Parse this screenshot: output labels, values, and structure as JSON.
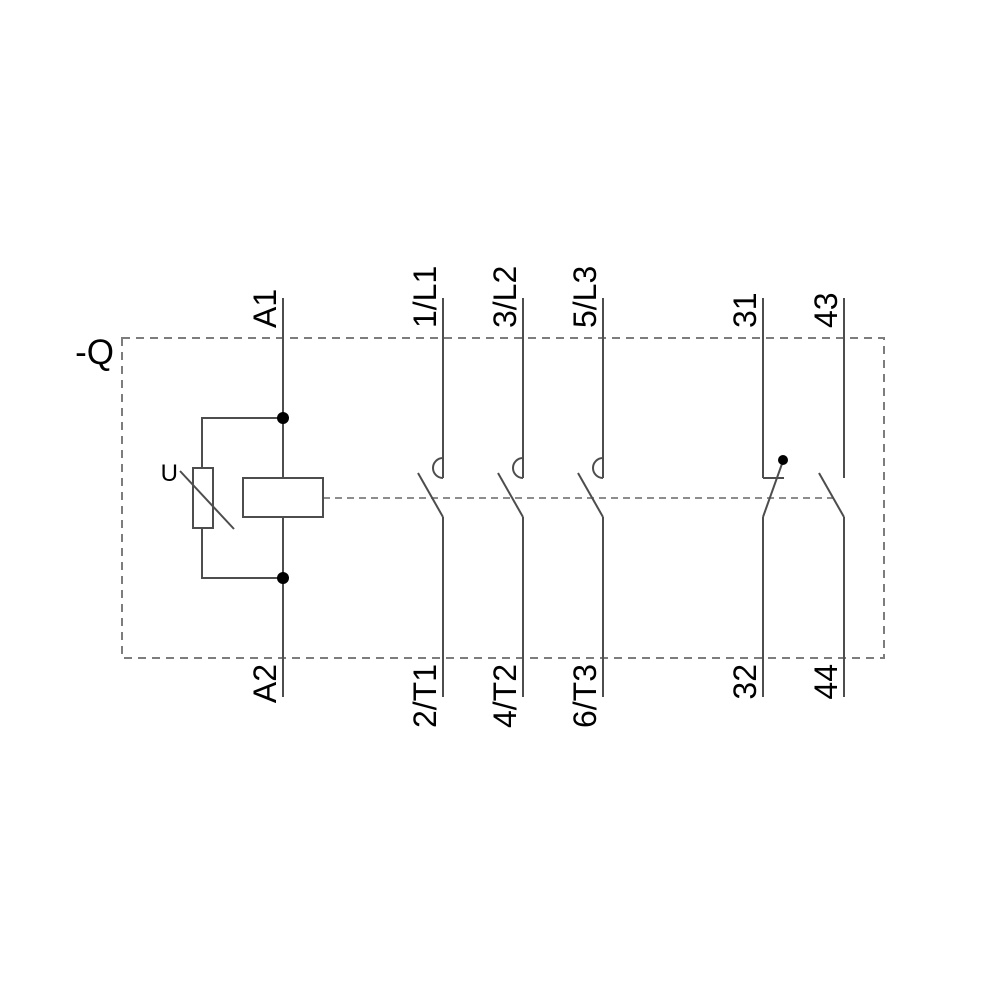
{
  "diagram": {
    "device_tag": "-Q",
    "suppressor_label": "U",
    "coil": {
      "top_terminal": "A1",
      "bottom_terminal": "A2"
    },
    "main_contacts": [
      {
        "top_terminal": "1/L1",
        "bottom_terminal": "2/T1"
      },
      {
        "top_terminal": "3/L2",
        "bottom_terminal": "4/T2"
      },
      {
        "top_terminal": "5/L3",
        "bottom_terminal": "6/T3"
      }
    ],
    "aux_contacts": [
      {
        "top_terminal": "31",
        "bottom_terminal": "32",
        "type": "NC"
      },
      {
        "top_terminal": "43",
        "bottom_terminal": "44",
        "type": "NO"
      }
    ],
    "colors": {
      "background": "#ffffff",
      "line": "#4d4d4d",
      "dashed": "#7d7d7d",
      "label": "#000000",
      "junction_dot": "#000000"
    }
  }
}
